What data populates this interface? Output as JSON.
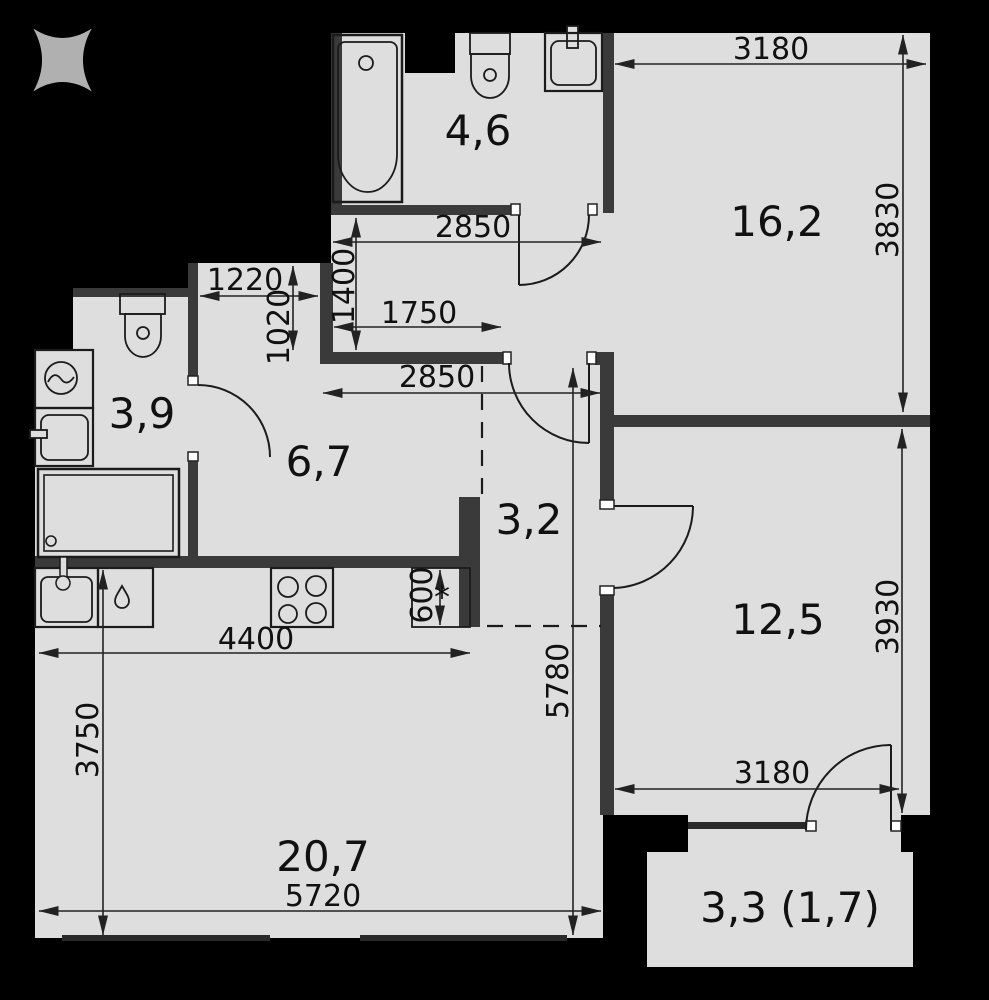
{
  "title": "apartment-floor-plan",
  "colors": {
    "background": "#000000",
    "floor": "#dedede",
    "interior_wall": "#3a3a3a",
    "line": "#1b1b1b",
    "jamb": "#ffffff",
    "logo": "#b0b0b0",
    "text": "#111111"
  },
  "logo": {
    "symbol": "x-star"
  },
  "rooms": [
    {
      "name": "bathroom-top",
      "area": "4,6"
    },
    {
      "name": "bedroom-top",
      "area": "16,2"
    },
    {
      "name": "wc-left",
      "area": "3,9"
    },
    {
      "name": "corridor",
      "area": "6,7"
    },
    {
      "name": "hallway",
      "area": "3,2"
    },
    {
      "name": "bedroom-right",
      "area": "12,5"
    },
    {
      "name": "kitchen-living",
      "area": "20,7"
    },
    {
      "name": "balcony",
      "area": "3,3 (1,7)"
    }
  ],
  "dimensions": {
    "top_width": "3180",
    "bedroom_top_height": "3830",
    "vestibule_width": "2850",
    "vestibule_depth": "1400",
    "niche_width": "1220",
    "niche_depth": "1020",
    "wall_run": "1750",
    "hall_width": "2850",
    "counter_depth": "600",
    "counter_depth_mark": "*",
    "kitchen_width": "4400",
    "kitchen_height": "3750",
    "inner_height": "5780",
    "bottom_width": "5720",
    "bedroom_right_height": "3930",
    "bedroom_right_width": "3180"
  }
}
